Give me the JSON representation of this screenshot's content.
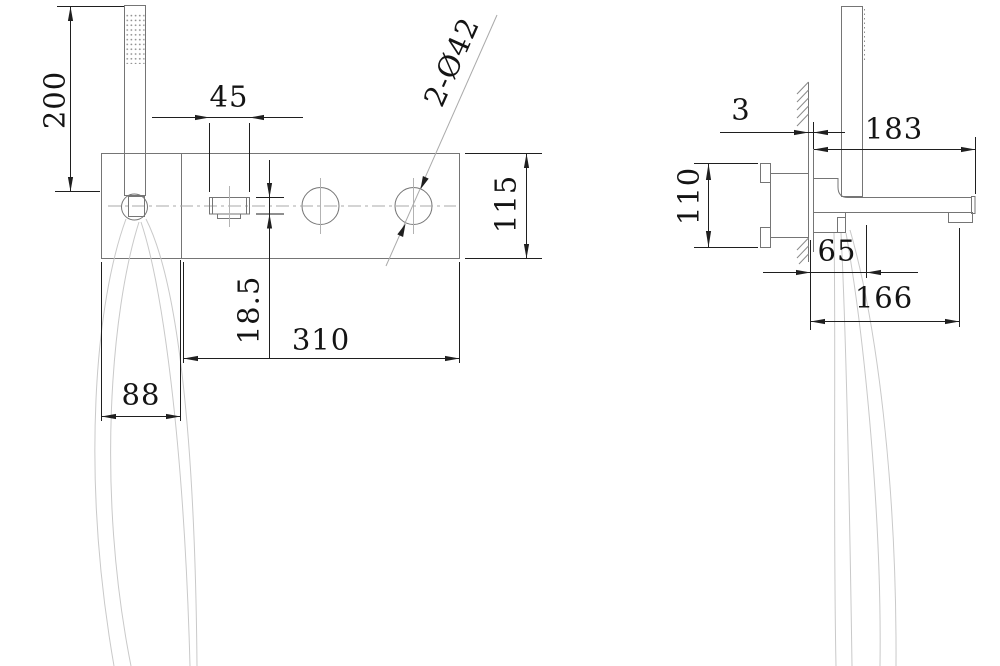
{
  "dims": {
    "front": {
      "shower_height": "200",
      "handle_width": "45",
      "hole_callout": "2-Ø42",
      "plate_height": "115",
      "handle_height": "18.5",
      "width_main": "310",
      "width_left": "88"
    },
    "side": {
      "plate_thickness": "3",
      "spout_reach": "183",
      "inlet_spacing": "110",
      "holder_offset": "65",
      "outlet_reach": "166"
    }
  }
}
